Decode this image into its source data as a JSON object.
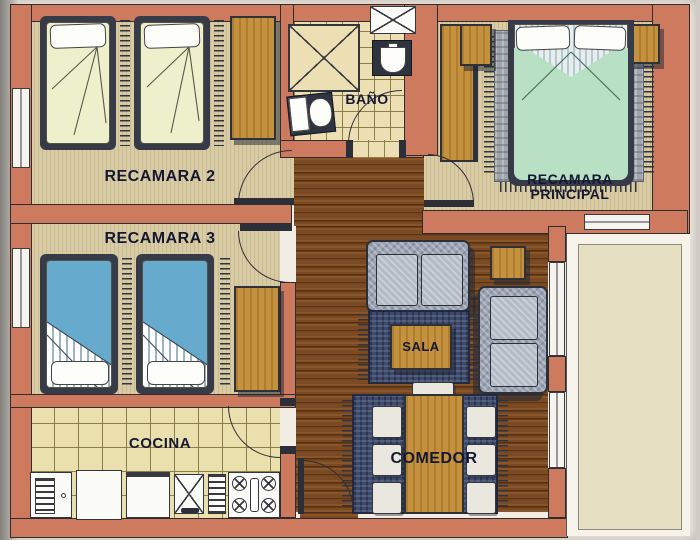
{
  "document": {
    "kind": "apartment-floor-plan"
  },
  "rooms": {
    "recamara2": {
      "label": "RECAMARA 2",
      "furniture": [
        "single-bed",
        "single-bed",
        "closet"
      ]
    },
    "recamara3": {
      "label": "RECAMARA 3",
      "furniture": [
        "single-bed",
        "single-bed",
        "closet"
      ]
    },
    "bano": {
      "label": "BAÑO",
      "furniture": [
        "shower",
        "sink",
        "toilet",
        "vent-duct"
      ]
    },
    "recamara_principal": {
      "label_line1": "RECAMARA",
      "label_line2": "PRINCIPAL",
      "furniture": [
        "double-bed",
        "nightstand",
        "nightstand",
        "closet",
        "rug"
      ]
    },
    "sala": {
      "label": "SALA",
      "furniture": [
        "sofa",
        "loveseat",
        "side-table",
        "coffee-table",
        "rug"
      ]
    },
    "cocina": {
      "label": "COCINA",
      "furniture": [
        "refrigerator",
        "counter",
        "dishwasher",
        "sink",
        "drainboard",
        "stove"
      ]
    },
    "comedor": {
      "label": "COMEDOR",
      "furniture": [
        "dining-table",
        "chair",
        "chair",
        "chair",
        "chair",
        "chair",
        "chair",
        "chair"
      ]
    }
  },
  "palette": {
    "wall": "#ce7a5e",
    "outline": "#2e2c2e",
    "carpet": "#d9cca4",
    "tile": "#eae0ae",
    "wood": "#7c4a22",
    "woodlight": "#c4913f",
    "rugnavy": "#3d4a6e",
    "ruggray": "#a0a5ac",
    "sofa": "#9aa3b2",
    "sheet2": "#eef0cc",
    "sheet3": "#66aacd",
    "sheetm": "#b7e0c4",
    "framedark": "#363b47",
    "paper": "#f1ede4"
  }
}
